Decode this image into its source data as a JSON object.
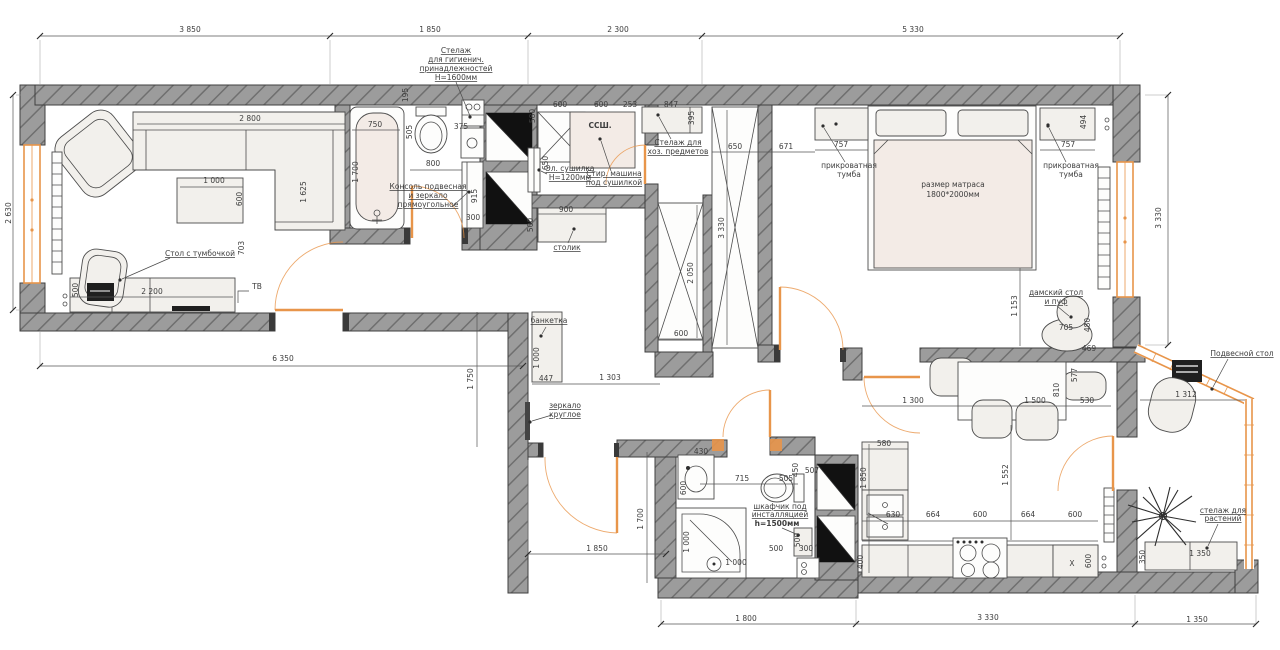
{
  "colors": {
    "paper": "#ffffff",
    "wall_fill": "#9c9c9c",
    "wall_hatch": "#6f6f6f",
    "outline": "#3f3f3f",
    "accent": "#e8954a",
    "furniture": "#f2f0ec",
    "soft": "#f3ebe6",
    "dim": "#3d3d3d"
  },
  "plan": {
    "units": "mm",
    "mattress_note": "размер матраса 1800*2000мм"
  },
  "annotations": [
    {
      "t": "3 850",
      "x": 190,
      "y": 32
    },
    {
      "t": "1 850",
      "x": 430,
      "y": 32
    },
    {
      "t": "2 300",
      "x": 618,
      "y": 32
    },
    {
      "t": "5 330",
      "x": 913,
      "y": 32
    },
    {
      "t": "Стелаж",
      "x": 456,
      "y": 53,
      "u": 1,
      "n": "label-shelf-hygiene"
    },
    {
      "t": "для гигиенич.",
      "x": 456,
      "y": 62,
      "u": 1,
      "n": "label-shelf-hygiene"
    },
    {
      "t": "принадлежностей",
      "x": 456,
      "y": 71,
      "u": 1,
      "n": "label-shelf-hygiene"
    },
    {
      "t": "Н=1600мм",
      "x": 456,
      "y": 80,
      "u": 1,
      "n": "label-shelf-hygiene"
    },
    {
      "t": "2 630",
      "x": 11,
      "y": 213,
      "r": 1
    },
    {
      "t": "3 330",
      "x": 1161,
      "y": 218,
      "r": 1
    },
    {
      "t": "2 800",
      "x": 250,
      "y": 121
    },
    {
      "t": "1 625",
      "x": 306,
      "y": 192,
      "r": 1
    },
    {
      "t": "1 000",
      "x": 214,
      "y": 183
    },
    {
      "t": "600",
      "x": 242,
      "y": 199,
      "r": 1
    },
    {
      "t": "703",
      "x": 244,
      "y": 248,
      "r": 1
    },
    {
      "t": "Стол с тумбочкой",
      "x": 200,
      "y": 256,
      "u": 1,
      "n": "label-desk"
    },
    {
      "t": "2 200",
      "x": 152,
      "y": 294
    },
    {
      "t": "500",
      "x": 78,
      "y": 290,
      "r": 1
    },
    {
      "t": "ТВ",
      "x": 257,
      "y": 289,
      "fs": 8,
      "n": "label-tv"
    },
    {
      "t": "6 350",
      "x": 283,
      "y": 361
    },
    {
      "t": "750",
      "x": 375,
      "y": 127
    },
    {
      "t": "1 700",
      "x": 358,
      "y": 172,
      "r": 1
    },
    {
      "t": "505",
      "x": 412,
      "y": 132,
      "r": 1
    },
    {
      "t": "375",
      "x": 461,
      "y": 129
    },
    {
      "t": "800",
      "x": 433,
      "y": 166
    },
    {
      "t": "Консоль подвесная",
      "x": 428,
      "y": 189,
      "u": 1,
      "n": "label-console"
    },
    {
      "t": "и зеркало",
      "x": 428,
      "y": 198,
      "u": 1,
      "n": "label-console"
    },
    {
      "t": "прямоугольное",
      "x": 428,
      "y": 207,
      "u": 1,
      "n": "label-console"
    },
    {
      "t": "915",
      "x": 477,
      "y": 196,
      "r": 1
    },
    {
      "t": "300",
      "x": 473,
      "y": 220
    },
    {
      "t": "195",
      "x": 408,
      "y": 95,
      "r": 1
    },
    {
      "t": "580",
      "x": 535,
      "y": 116,
      "r": 1
    },
    {
      "t": "600",
      "x": 560,
      "y": 107
    },
    {
      "t": "600",
      "x": 601,
      "y": 107
    },
    {
      "t": "253",
      "x": 630,
      "y": 107
    },
    {
      "t": "847",
      "x": 671,
      "y": 107
    },
    {
      "t": "395",
      "x": 694,
      "y": 118,
      "r": 1
    },
    {
      "t": "ССШ.",
      "x": 600,
      "y": 128,
      "fs": 10,
      "b": 1,
      "n": "label-washer-column"
    },
    {
      "t": "650",
      "x": 548,
      "y": 163,
      "r": 1
    },
    {
      "t": "Эл. сушилка",
      "x": 570,
      "y": 171,
      "u": 1,
      "n": "label-dryer"
    },
    {
      "t": "Н=1200мм",
      "x": 570,
      "y": 180,
      "u": 1,
      "n": "label-dryer"
    },
    {
      "t": "Стир. машина",
      "x": 614,
      "y": 176,
      "u": 1,
      "n": "label-washer"
    },
    {
      "t": "под сушилкой",
      "x": 614,
      "y": 185,
      "u": 1,
      "n": "label-washer"
    },
    {
      "t": "Стелаж для",
      "x": 678,
      "y": 145,
      "u": 1,
      "n": "label-shelf-household"
    },
    {
      "t": "хоз. предметов",
      "x": 678,
      "y": 154,
      "u": 1,
      "n": "label-shelf-household"
    },
    {
      "t": "900",
      "x": 566,
      "y": 212
    },
    {
      "t": "500",
      "x": 533,
      "y": 225,
      "r": 1
    },
    {
      "t": "столик",
      "x": 567,
      "y": 250,
      "u": 1,
      "n": "label-small-table"
    },
    {
      "t": "650",
      "x": 735,
      "y": 149
    },
    {
      "t": "671",
      "x": 786,
      "y": 149
    },
    {
      "t": "3 330",
      "x": 724,
      "y": 228,
      "r": 1
    },
    {
      "t": "2 050",
      "x": 693,
      "y": 273,
      "r": 1
    },
    {
      "t": "600",
      "x": 681,
      "y": 336
    },
    {
      "t": "банкетка",
      "x": 549,
      "y": 323,
      "u": 1,
      "n": "label-bench"
    },
    {
      "t": "1 000",
      "x": 539,
      "y": 358,
      "r": 1
    },
    {
      "t": "447",
      "x": 546,
      "y": 381
    },
    {
      "t": "1 303",
      "x": 610,
      "y": 380
    },
    {
      "t": "1 750",
      "x": 473,
      "y": 379,
      "r": 1
    },
    {
      "t": "зеркало",
      "x": 565,
      "y": 408,
      "u": 1,
      "n": "label-round-mirror"
    },
    {
      "t": "круглое",
      "x": 565,
      "y": 417,
      "u": 1,
      "n": "label-round-mirror"
    },
    {
      "t": "1 850",
      "x": 597,
      "y": 551
    },
    {
      "t": "1 700",
      "x": 643,
      "y": 519,
      "r": 1
    },
    {
      "t": "757",
      "x": 841,
      "y": 147
    },
    {
      "t": "757",
      "x": 1068,
      "y": 147
    },
    {
      "t": "494",
      "x": 1086,
      "y": 122,
      "r": 1
    },
    {
      "t": "прикроватная",
      "x": 849,
      "y": 168,
      "n": "label-nightstand-left"
    },
    {
      "t": "тумба",
      "x": 849,
      "y": 177,
      "n": "label-nightstand-left"
    },
    {
      "t": "прикроватная",
      "x": 1071,
      "y": 168,
      "n": "label-nightstand-right"
    },
    {
      "t": "тумба",
      "x": 1071,
      "y": 177,
      "n": "label-nightstand-right"
    },
    {
      "t": "размер матраса",
      "x": 953,
      "y": 187,
      "n": "label-mattress"
    },
    {
      "t": "1800*2000мм",
      "x": 953,
      "y": 197,
      "n": "label-mattress"
    },
    {
      "t": "дамский стол",
      "x": 1056,
      "y": 295,
      "u": 1,
      "n": "label-vanity"
    },
    {
      "t": "и пуф",
      "x": 1056,
      "y": 304,
      "u": 1,
      "n": "label-vanity"
    },
    {
      "t": "705",
      "x": 1066,
      "y": 330
    },
    {
      "t": "480",
      "x": 1090,
      "y": 325,
      "r": 1
    },
    {
      "t": "1 153",
      "x": 1017,
      "y": 306,
      "r": 1
    },
    {
      "t": "1 300",
      "x": 913,
      "y": 403
    },
    {
      "t": "1 500",
      "x": 1035,
      "y": 403
    },
    {
      "t": "530",
      "x": 1087,
      "y": 403
    },
    {
      "t": "810",
      "x": 1059,
      "y": 390,
      "r": 1
    },
    {
      "t": "580",
      "x": 884,
      "y": 446
    },
    {
      "t": "1 850",
      "x": 866,
      "y": 478,
      "r": 1
    },
    {
      "t": "1 552",
      "x": 1008,
      "y": 475,
      "r": 1
    },
    {
      "t": "630",
      "x": 893,
      "y": 517
    },
    {
      "t": "664",
      "x": 933,
      "y": 517
    },
    {
      "t": "600",
      "x": 980,
      "y": 517
    },
    {
      "t": "664",
      "x": 1028,
      "y": 517
    },
    {
      "t": "600",
      "x": 1075,
      "y": 517
    },
    {
      "t": "400",
      "x": 863,
      "y": 562,
      "r": 1
    },
    {
      "t": "600",
      "x": 1091,
      "y": 561,
      "r": 1
    },
    {
      "t": "X",
      "x": 1072,
      "y": 566,
      "fs": 10,
      "n": "label-x-cabinet"
    },
    {
      "t": "3 330",
      "x": 988,
      "y": 620
    },
    {
      "t": "430",
      "x": 701,
      "y": 454
    },
    {
      "t": "600",
      "x": 686,
      "y": 488,
      "r": 1
    },
    {
      "t": "715",
      "x": 742,
      "y": 481
    },
    {
      "t": "505",
      "x": 786,
      "y": 481
    },
    {
      "t": "450",
      "x": 798,
      "y": 470,
      "r": 1
    },
    {
      "t": "507",
      "x": 812,
      "y": 473
    },
    {
      "t": "шкафчик под",
      "x": 780,
      "y": 509,
      "u": 1,
      "n": "label-cabinet-installation"
    },
    {
      "t": "инсталляцией",
      "x": 780,
      "y": 517,
      "u": 1,
      "n": "label-cabinet-installation"
    },
    {
      "t": "h=1500мм",
      "x": 777,
      "y": 526,
      "b": 1,
      "n": "label-cabinet-installation"
    },
    {
      "t": "1 000",
      "x": 689,
      "y": 542,
      "r": 1
    },
    {
      "t": "1 000",
      "x": 736,
      "y": 565
    },
    {
      "t": "500",
      "x": 776,
      "y": 551
    },
    {
      "t": "300",
      "x": 806,
      "y": 551
    },
    {
      "t": "500",
      "x": 800,
      "y": 540,
      "r": 1
    },
    {
      "t": "1 800",
      "x": 746,
      "y": 621
    },
    {
      "t": "469",
      "x": 1089,
      "y": 351
    },
    {
      "t": "577",
      "x": 1077,
      "y": 375,
      "r": 1
    },
    {
      "t": "1 312",
      "x": 1186,
      "y": 397
    },
    {
      "t": "Подвесной стол",
      "x": 1242,
      "y": 356,
      "u": 1,
      "n": "label-hanging-table"
    },
    {
      "t": "стелаж для",
      "x": 1223,
      "y": 513,
      "u": 1,
      "n": "label-plant-shelf"
    },
    {
      "t": "растений",
      "x": 1223,
      "y": 521,
      "u": 1,
      "n": "label-plant-shelf"
    },
    {
      "t": "350",
      "x": 1145,
      "y": 557,
      "r": 1
    },
    {
      "t": "1 350",
      "x": 1200,
      "y": 556
    },
    {
      "t": "1 350",
      "x": 1197,
      "y": 622
    }
  ]
}
